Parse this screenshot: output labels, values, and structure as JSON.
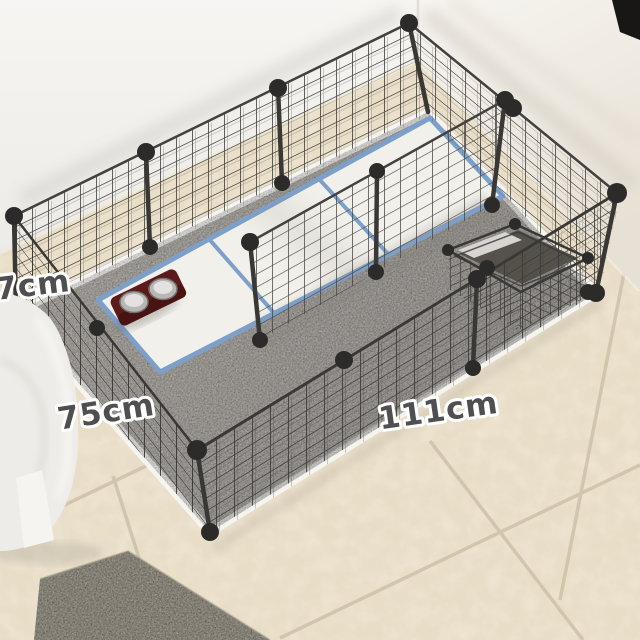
{
  "meta": {
    "type": "ecommerce-product-photo",
    "subject": "DIY black wire-grid pet playpen set up in a room corner"
  },
  "dimension_labels": {
    "height": "7cm",
    "width": "75cm",
    "length": "111cm"
  },
  "objects": {
    "playpen": "black wire grid panel pet fence",
    "divider": "interior wire grid divider panel",
    "mat": "white plastic mat with blue trim (3 squares)",
    "feeder": "dark red double food-bowl stand with two stainless bowls",
    "basket": "small wire grid pet bed basket",
    "inner_rug": "light gray plush rug inside pen",
    "outer_rug": "dark gray shag rug on floor",
    "sofa": "white fabric sofa armrest",
    "floor": "beige ceramic tile floor with diagonal grout",
    "wall": "white wall corner",
    "dark_corner": "dark object in top-right corner"
  },
  "colors": {
    "wire": "#3e3c39",
    "connector_ball": "#2d2b29",
    "mat_trim": "#7da0cb",
    "mat_fill": "#f2f0ea",
    "feeder_red": "#5c1a1a",
    "tile": "#e8ddc6",
    "grout": "#cdc1a9",
    "inner_rug": "#a29d96",
    "outer_rug": "#868071",
    "label_text": "#4f4f4f",
    "label_outline": "#ffffff"
  }
}
